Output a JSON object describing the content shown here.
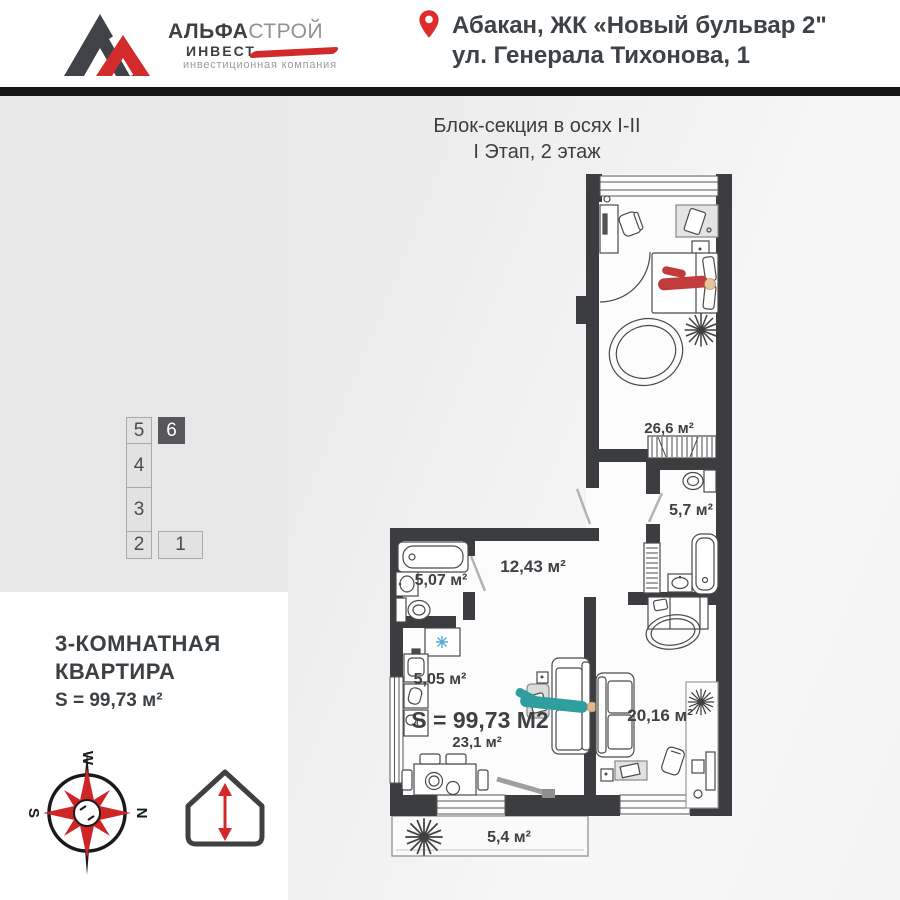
{
  "header": {
    "logo": {
      "name_bold": "АЛЬФА",
      "name_light": "СТРОЙ",
      "sub": "ИНВЕСТ",
      "tagline": "инвестиционная компания"
    },
    "address": {
      "line1": "Абакан, ЖК «Новый бульвар 2\"",
      "line2": "ул. Генерала Тихонова, 1"
    }
  },
  "section": {
    "title_line1": "Блок-секция в осях  I-II",
    "title_line2": "I Этап, 2 этаж"
  },
  "stack": {
    "cells": [
      "5",
      "6",
      "4",
      "3",
      "2",
      "1"
    ],
    "selected": "6"
  },
  "apartment": {
    "line1": "3-КОМНАТНАЯ",
    "line2": "КВАРТИРА",
    "area": "S = 99,73 м²"
  },
  "plan": {
    "total_area": "S = 99,73 М2",
    "rooms": {
      "bedroom1": "26,6 м²",
      "bath_small": "5,7 м²",
      "hallway": "12,43 м²",
      "bathroom": "5,07 м²",
      "kitchen": "5,05 м²",
      "living": "23,1 м²",
      "bedroom2": "20,16 м²",
      "balcony": "5,4 м²"
    }
  },
  "compass": {
    "w": "W",
    "n": "N",
    "s": "S"
  },
  "colors": {
    "accent_red": "#d22a2a",
    "wall": "#3b3d40",
    "person_teal": "#2f9e9e",
    "person_red": "#c23b3b",
    "snowflake_blue": "#5aa8dc"
  }
}
